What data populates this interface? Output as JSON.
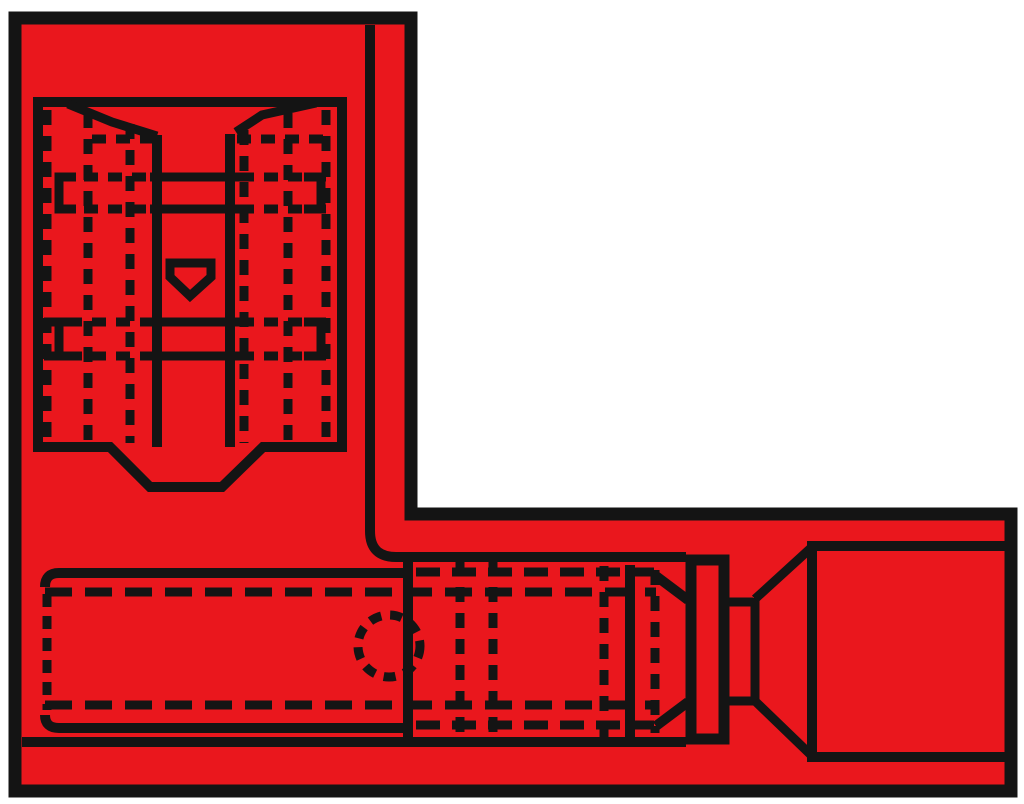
{
  "figure": {
    "kind": "line-drawing",
    "subject": "red insulated flag-style terminal connector, L-shaped profile with hidden (dashed) contour lines"
  },
  "canvas": {
    "width": 1024,
    "height": 804
  },
  "colors": {
    "background": "#FFFFFF",
    "body": "#EA171D",
    "line": "#141414"
  },
  "shapes": [
    {
      "name": "body-outline",
      "type": "path",
      "d": "M15,18 H411 V514 H1011 V791 H15 Z",
      "sw": 13,
      "fill": "body"
    },
    {
      "name": "sleeve-collar",
      "type": "path",
      "d": "M691,560 H724 V739 H691 Z",
      "sw": 11,
      "fill": "body"
    },
    {
      "name": "detent-pentagon",
      "type": "path",
      "d": "M170,263 H211 V277 L190,296 L170,277 Z",
      "sw": 9,
      "fill": "body"
    },
    {
      "name": "receptacle-box",
      "type": "path",
      "d": "M38,102 H342 V447 H263 L222,487 H150 L110,447 H38 Z",
      "sw": 10
    },
    {
      "name": "mouth-chamfer-left",
      "type": "path",
      "d": "M68,104 L112,122 L157,136",
      "sw": 9
    },
    {
      "name": "mouth-chamfer-right",
      "type": "path",
      "d": "M316,103 L262,115 L236,132",
      "sw": 9
    },
    {
      "name": "tab-slot-left-wall",
      "type": "path",
      "d": "M157,135 V447",
      "sw": 10
    },
    {
      "name": "tab-slot-right-wall",
      "type": "path",
      "d": "M230,134 V447",
      "sw": 10
    },
    {
      "name": "slot-rung-1",
      "type": "path",
      "d": "M150,177 H240",
      "sw": 9
    },
    {
      "name": "slot-rung-2",
      "type": "path",
      "d": "M150,209 H240",
      "sw": 9
    },
    {
      "name": "slot-rung-3",
      "type": "path",
      "d": "M150,322 H240",
      "sw": 9
    },
    {
      "name": "slot-rung-4",
      "type": "path",
      "d": "M150,356 H240",
      "sw": 9
    },
    {
      "name": "spring-bracket-upper-left",
      "type": "path",
      "d": "M76,177 H59 V209 H76",
      "sw": 9
    },
    {
      "name": "spring-bracket-upper-right",
      "type": "path",
      "d": "M304,177 H321 V209 H304",
      "sw": 9
    },
    {
      "name": "spring-bracket-lower-left",
      "type": "path",
      "d": "M76,322 H59 V356 H76",
      "sw": 9
    },
    {
      "name": "spring-bracket-lower-right",
      "type": "path",
      "d": "M304,322 H321 V356 H304",
      "sw": 9
    },
    {
      "name": "sleeve-edge",
      "type": "path",
      "d": "M370,25 V531 Q370,557 396,557 H686",
      "sw": 10
    },
    {
      "name": "barrel-top",
      "type": "path",
      "d": "M45,587 Q45,573 59,573 H406",
      "sw": 10
    },
    {
      "name": "barrel-bottom",
      "type": "path",
      "d": "M45,715 Q45,728 59,728 H410",
      "sw": 10
    },
    {
      "name": "sleeve-bottom",
      "type": "path",
      "d": "M22,742 H686",
      "sw": 10
    },
    {
      "name": "barrel-front-edge",
      "type": "path",
      "d": "M408,557 V741",
      "sw": 10
    },
    {
      "name": "inner-sleeve-edge",
      "type": "path",
      "d": "M630,565 V738",
      "sw": 10
    },
    {
      "name": "taper-top",
      "type": "path",
      "d": "M656,576 L688,600",
      "sw": 10
    },
    {
      "name": "taper-bottom",
      "type": "path",
      "d": "M656,726 L688,702",
      "sw": 10
    },
    {
      "name": "neck-top",
      "type": "path",
      "d": "M729,602 H753",
      "sw": 9
    },
    {
      "name": "neck-bottom",
      "type": "path",
      "d": "M729,701 H753",
      "sw": 9
    },
    {
      "name": "funnel-mouth-edge",
      "type": "path",
      "d": "M755,598 V703",
      "sw": 9
    },
    {
      "name": "funnel-upper-diagonal",
      "type": "path",
      "d": "M755,599 L812,547",
      "sw": 9
    },
    {
      "name": "funnel-lower-diagonal",
      "type": "path",
      "d": "M755,701 L812,756",
      "sw": 9
    },
    {
      "name": "wire-entry-rect",
      "type": "path",
      "d": "M1008,546 H812 V757 H1008",
      "sw": 10
    },
    {
      "name": "hidden-pillar-left-1",
      "type": "path",
      "d": "M47,110 V443",
      "sw": 9,
      "dash": "15 11"
    },
    {
      "name": "hidden-pillar-left-2",
      "type": "path",
      "d": "M88,113 V443",
      "sw": 9,
      "dash": "15 11"
    },
    {
      "name": "hidden-pillar-left-3",
      "type": "path",
      "d": "M130,124 V443",
      "sw": 9,
      "dash": "15 11"
    },
    {
      "name": "hidden-pillar-right-1",
      "type": "path",
      "d": "M244,130 V443",
      "sw": 9,
      "dash": "15 11"
    },
    {
      "name": "hidden-pillar-right-2",
      "type": "path",
      "d": "M288,113 V443",
      "sw": 9,
      "dash": "15 11"
    },
    {
      "name": "hidden-pillar-right-3",
      "type": "path",
      "d": "M326,110 V443",
      "sw": 9,
      "dash": "15 11"
    },
    {
      "name": "hidden-lip-left",
      "type": "path",
      "d": "M92,139 H153",
      "sw": 9,
      "dash": "14 10"
    },
    {
      "name": "hidden-lip-right",
      "type": "path",
      "d": "M237,139 H330",
      "sw": 9,
      "dash": "14 10"
    },
    {
      "name": "hidden-rung1-left",
      "type": "path",
      "d": "M60,177 H150",
      "sw": 9,
      "dash": "14 10"
    },
    {
      "name": "hidden-rung1-right",
      "type": "path",
      "d": "M240,177 H334",
      "sw": 9,
      "dash": "14 10"
    },
    {
      "name": "hidden-rung2-left",
      "type": "path",
      "d": "M60,209 H150",
      "sw": 9,
      "dash": "14 10"
    },
    {
      "name": "hidden-rung2-right",
      "type": "path",
      "d": "M240,209 H334",
      "sw": 9,
      "dash": "14 10"
    },
    {
      "name": "hidden-rung3-left",
      "type": "path",
      "d": "M44,322 H150",
      "sw": 9,
      "dash": "14 10"
    },
    {
      "name": "hidden-rung3-right",
      "type": "path",
      "d": "M240,322 H334",
      "sw": 9,
      "dash": "14 10"
    },
    {
      "name": "hidden-rung4-left",
      "type": "path",
      "d": "M44,356 H150",
      "sw": 9,
      "dash": "14 10"
    },
    {
      "name": "hidden-rung4-right",
      "type": "path",
      "d": "M240,356 H334",
      "sw": 9,
      "dash": "14 10"
    },
    {
      "name": "hidden-barrel-end",
      "type": "path",
      "d": "M47,594 V710",
      "sw": 9,
      "dash": "13 9"
    },
    {
      "name": "hidden-barrel-top",
      "type": "path",
      "d": "M416,572 H654",
      "sw": 9,
      "dash": "24 12"
    },
    {
      "name": "hidden-liner-top",
      "type": "path",
      "d": "M45,592 H656",
      "sw": 9,
      "dash": "27 13"
    },
    {
      "name": "hidden-liner-bottom",
      "type": "path",
      "d": "M45,705 H656",
      "sw": 9,
      "dash": "27 13"
    },
    {
      "name": "hidden-barrel-bottom",
      "type": "path",
      "d": "M416,725 H654",
      "sw": 9,
      "dash": "24 12"
    },
    {
      "name": "hidden-crimp-1",
      "type": "path",
      "d": "M460,561 V738",
      "sw": 9,
      "dash": "15 11"
    },
    {
      "name": "hidden-crimp-2",
      "type": "path",
      "d": "M493,561 V738",
      "sw": 9,
      "dash": "15 11"
    },
    {
      "name": "hidden-crimp-3",
      "type": "path",
      "d": "M604,566 V737",
      "sw": 9,
      "dash": "15 11"
    },
    {
      "name": "hidden-crimp-4",
      "type": "path",
      "d": "M655,570 V733",
      "sw": 9,
      "dash": "15 11"
    },
    {
      "name": "inspection-hole",
      "type": "circle",
      "cx": 389,
      "cy": 646,
      "r": 31,
      "sw": 9,
      "dash": "12 9"
    }
  ]
}
